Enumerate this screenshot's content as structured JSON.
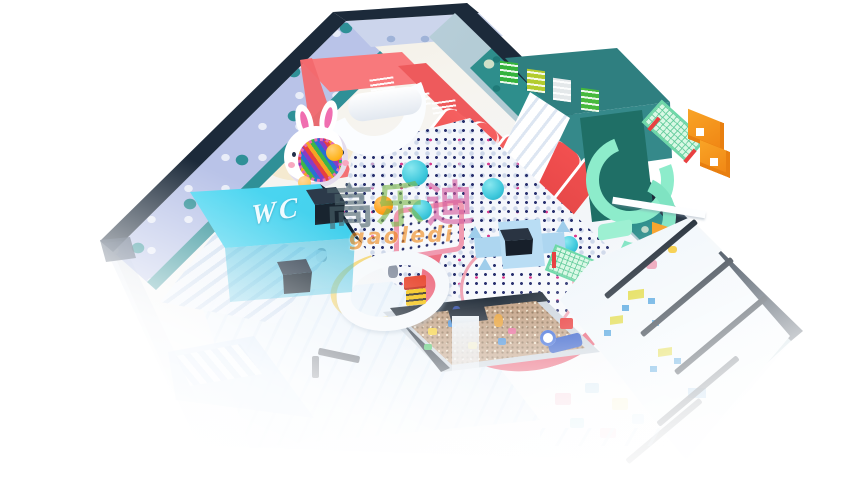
{
  "wc_sign": {
    "label": "WC"
  },
  "watermark": {
    "chars": [
      "高",
      "乐",
      "迪"
    ],
    "latin": "gaoledi"
  },
  "colors": {
    "wall_navy": "#1c2a3a",
    "wall_periwinkle": "#b9c3e8",
    "wall_teal": "#2e8e8c",
    "polka_dot_teal": "#2f9097",
    "pink_wall": "#f2696e",
    "slide_red": "#ee4c4c",
    "wc_cyan": "#2ec6e8",
    "castle_blue": "#aed6f0",
    "ball_dot_navy": "#28306e",
    "mint_slide": "#8deccb",
    "climb_orange": "#f5941d",
    "door_panel_green": "#35b33c",
    "sand": "#c2a083",
    "ghost_blue": "#cfe3f6",
    "furniture_yellow": "#dfd838",
    "furniture_blue": "#3f9bdc",
    "watermark_orange": "#f08818"
  }
}
